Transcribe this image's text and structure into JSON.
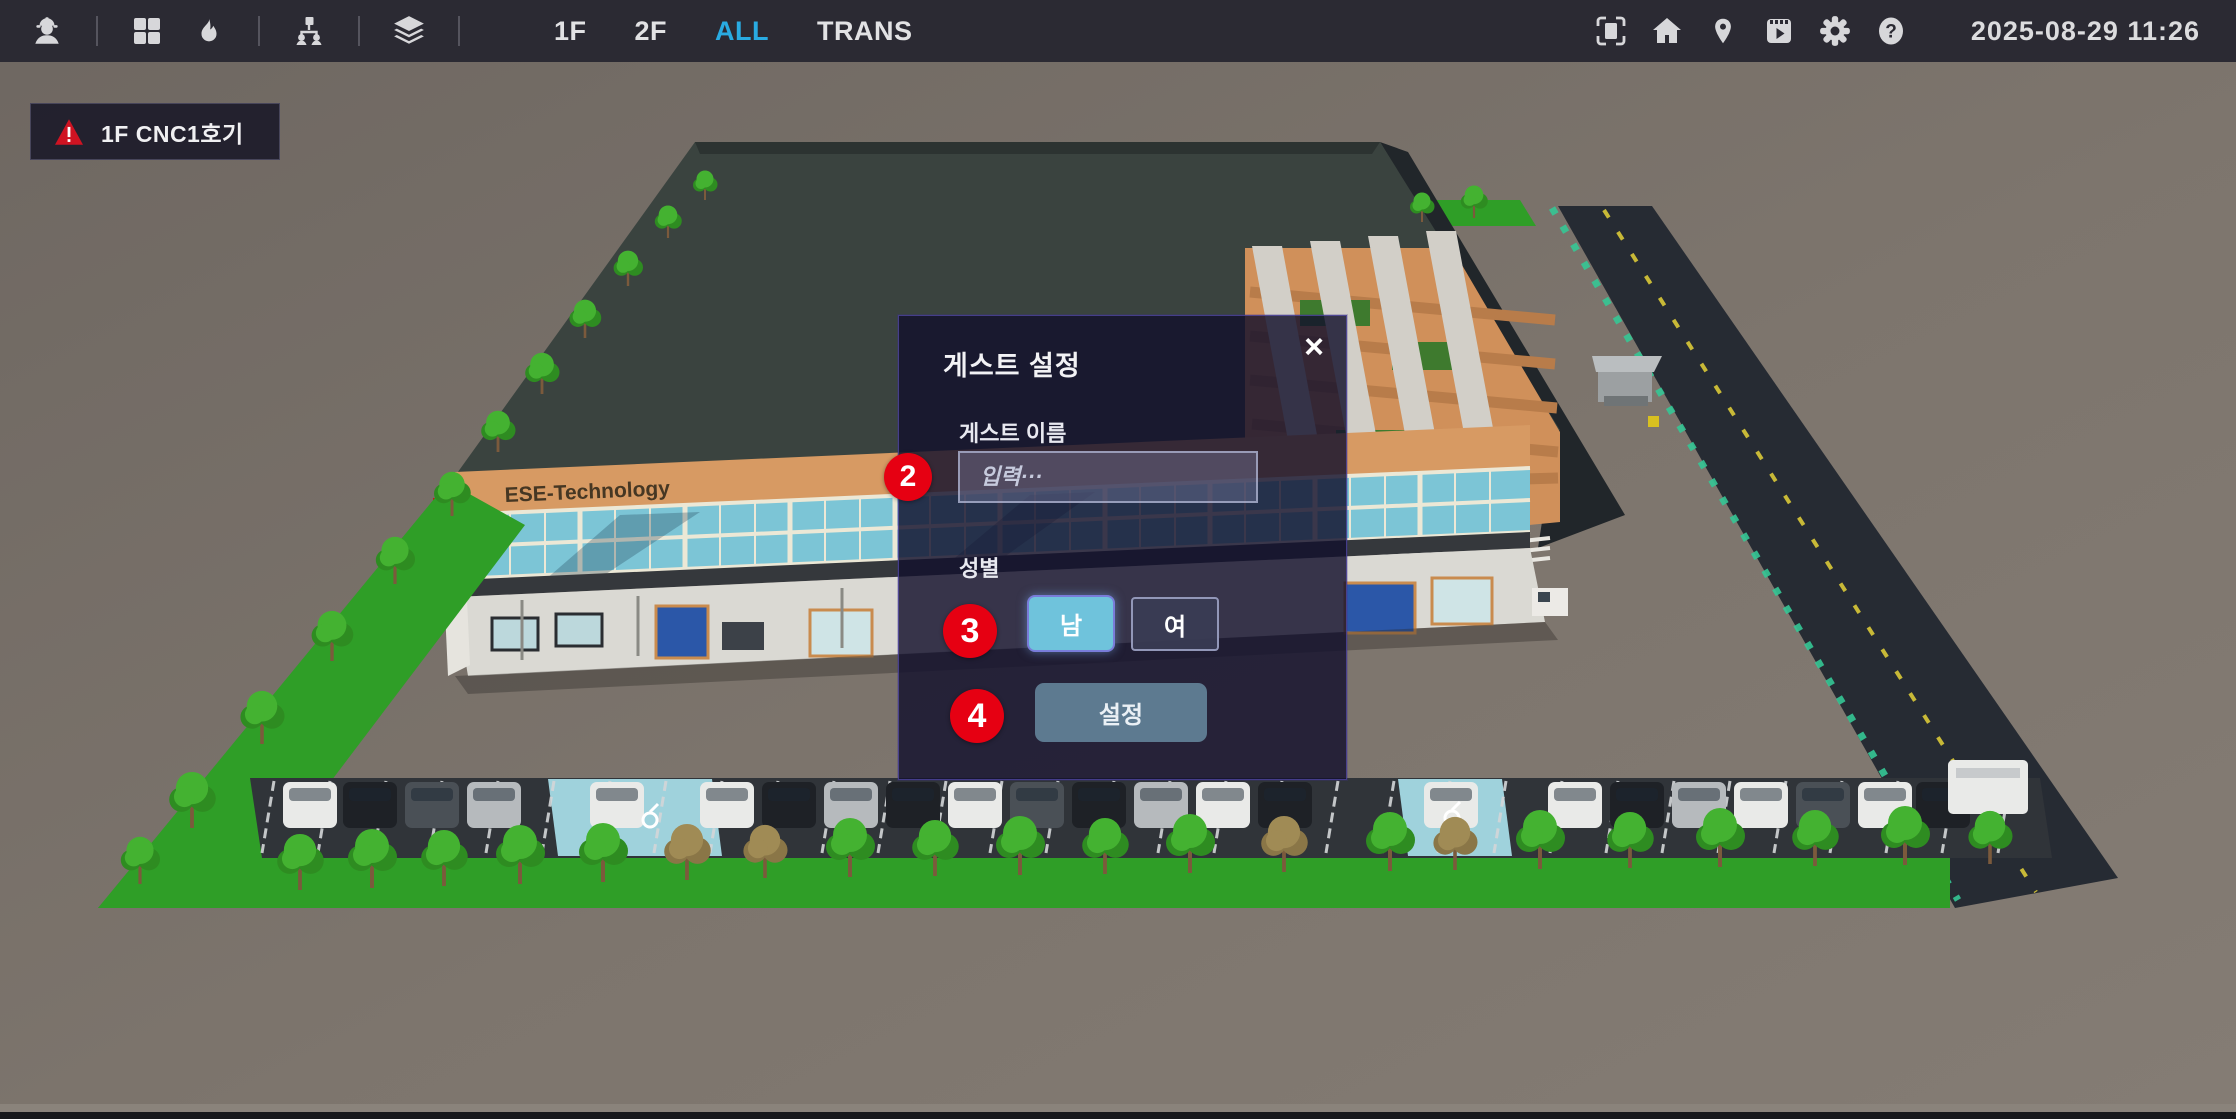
{
  "topbar": {
    "left_icons": [
      "guest-helmet",
      "grid",
      "flame",
      "org-chart",
      "layers"
    ],
    "floors": [
      {
        "label": "1F",
        "active": false
      },
      {
        "label": "2F",
        "active": false
      },
      {
        "label": "ALL",
        "active": true
      },
      {
        "label": "TRANS",
        "active": false
      }
    ],
    "right_icons": [
      "fullscreen",
      "home",
      "map-pin",
      "video",
      "gear",
      "help"
    ],
    "datetime": "2025-08-29 11:26",
    "colors": {
      "bar_bg": "#2b2a33",
      "icon": "#d7d7da",
      "active_floor": "#29abe2"
    }
  },
  "alert": {
    "label": "1F CNC1호기",
    "severity": "warning",
    "color": "#cf1322"
  },
  "dialog": {
    "title": "게스트 설정",
    "close": "×",
    "name_label": "게스트 이름",
    "name_placeholder": "입력···",
    "name_value": "",
    "gender_label": "성별",
    "gender_options": [
      {
        "label": "남",
        "selected": true
      },
      {
        "label": "여",
        "selected": false
      }
    ],
    "submit": "설정",
    "colors": {
      "panel": "rgba(18,16,44,0.82)",
      "selected_gender": "#6fc3dc",
      "submit": "#5d7a90"
    }
  },
  "markers": [
    {
      "label": "2"
    },
    {
      "label": "3"
    },
    {
      "label": "4"
    }
  ],
  "scene": {
    "building_sign": "ESE-Technology",
    "palette": {
      "ground1": "#6e6761",
      "ground2": "#847c74",
      "roof": "#3a433f",
      "rim": "#21262a",
      "orange": "#d79a63",
      "orange_dark": "#b97e4c",
      "glass": "#7cc5d6",
      "mullion": "#ece8d6",
      "slab": "#35383c",
      "wall": "#dad9d3",
      "grass": "#2f9e27",
      "road": "#262b33",
      "road_line": "#c8b937",
      "fence": "#35c795",
      "parking": "#303439",
      "stall": "#d4d6d8",
      "blue_bay": "#9fd2dc",
      "pipe": "#d2cfc8",
      "pipe_base": "#8f8d86",
      "tree_green": "#44b231",
      "tree_dark": "#2e8c21",
      "tree_dry": "#a08b55",
      "trunk": "#7b5a3c",
      "car_white": "#e9eae8",
      "car_black": "#1e2126",
      "car_silver": "#b6babd",
      "car_dkgray": "#4a5056"
    },
    "cars": [
      {
        "x": 283,
        "c": "car_white"
      },
      {
        "x": 343,
        "c": "car_black"
      },
      {
        "x": 405,
        "c": "car_dkgray"
      },
      {
        "x": 467,
        "c": "car_silver"
      },
      {
        "x": 590,
        "c": "car_white"
      },
      {
        "x": 700,
        "c": "car_white"
      },
      {
        "x": 762,
        "c": "car_black"
      },
      {
        "x": 824,
        "c": "car_silver"
      },
      {
        "x": 886,
        "c": "car_black"
      },
      {
        "x": 948,
        "c": "car_white"
      },
      {
        "x": 1010,
        "c": "car_dkgray"
      },
      {
        "x": 1072,
        "c": "car_black"
      },
      {
        "x": 1134,
        "c": "car_silver"
      },
      {
        "x": 1196,
        "c": "car_white"
      },
      {
        "x": 1258,
        "c": "car_black"
      },
      {
        "x": 1424,
        "c": "car_white"
      },
      {
        "x": 1548,
        "c": "car_white"
      },
      {
        "x": 1610,
        "c": "car_black"
      },
      {
        "x": 1672,
        "c": "car_silver"
      },
      {
        "x": 1734,
        "c": "car_white"
      },
      {
        "x": 1796,
        "c": "car_dkgray"
      },
      {
        "x": 1858,
        "c": "car_white"
      },
      {
        "x": 1916,
        "c": "car_black"
      }
    ],
    "truck": {
      "x": 1948,
      "y": 760,
      "w": 80,
      "h": 54
    },
    "trees": [
      {
        "x": 705,
        "y": 200,
        "s": 0.5
      },
      {
        "x": 668,
        "y": 238,
        "s": 0.55
      },
      {
        "x": 628,
        "y": 286,
        "s": 0.6
      },
      {
        "x": 585,
        "y": 338,
        "s": 0.65
      },
      {
        "x": 542,
        "y": 394,
        "s": 0.7
      },
      {
        "x": 498,
        "y": 452,
        "s": 0.7
      },
      {
        "x": 452,
        "y": 516,
        "s": 0.75
      },
      {
        "x": 395,
        "y": 584,
        "s": 0.8
      },
      {
        "x": 332,
        "y": 661,
        "s": 0.85
      },
      {
        "x": 262,
        "y": 744,
        "s": 0.9
      },
      {
        "x": 192,
        "y": 828,
        "s": 0.95
      },
      {
        "x": 140,
        "y": 884,
        "s": 0.8
      },
      {
        "x": 1422,
        "y": 222,
        "s": 0.5
      },
      {
        "x": 1474,
        "y": 218,
        "s": 0.55
      },
      {
        "x": 300,
        "y": 890,
        "s": 0.95
      },
      {
        "x": 372,
        "y": 888,
        "s": 1.0
      },
      {
        "x": 444,
        "y": 886,
        "s": 0.95
      },
      {
        "x": 520,
        "y": 884,
        "s": 1.0
      },
      {
        "x": 603,
        "y": 882,
        "s": 1.0
      },
      {
        "x": 687,
        "y": 880,
        "s": 0.95,
        "dry": true
      },
      {
        "x": 765,
        "y": 878,
        "s": 0.9,
        "dry": true
      },
      {
        "x": 850,
        "y": 877,
        "s": 1.0
      },
      {
        "x": 935,
        "y": 876,
        "s": 0.95
      },
      {
        "x": 1020,
        "y": 875,
        "s": 1.0
      },
      {
        "x": 1105,
        "y": 874,
        "s": 0.95
      },
      {
        "x": 1190,
        "y": 873,
        "s": 1.0
      },
      {
        "x": 1284,
        "y": 872,
        "s": 0.95,
        "dry": true
      },
      {
        "x": 1390,
        "y": 871,
        "s": 1.0
      },
      {
        "x": 1455,
        "y": 870,
        "s": 0.9,
        "dry": true
      },
      {
        "x": 1540,
        "y": 869,
        "s": 1.0
      },
      {
        "x": 1630,
        "y": 868,
        "s": 0.95
      },
      {
        "x": 1720,
        "y": 867,
        "s": 1.0
      },
      {
        "x": 1815,
        "y": 866,
        "s": 0.95
      },
      {
        "x": 1905,
        "y": 865,
        "s": 1.0
      },
      {
        "x": 1990,
        "y": 864,
        "s": 0.9
      }
    ]
  }
}
